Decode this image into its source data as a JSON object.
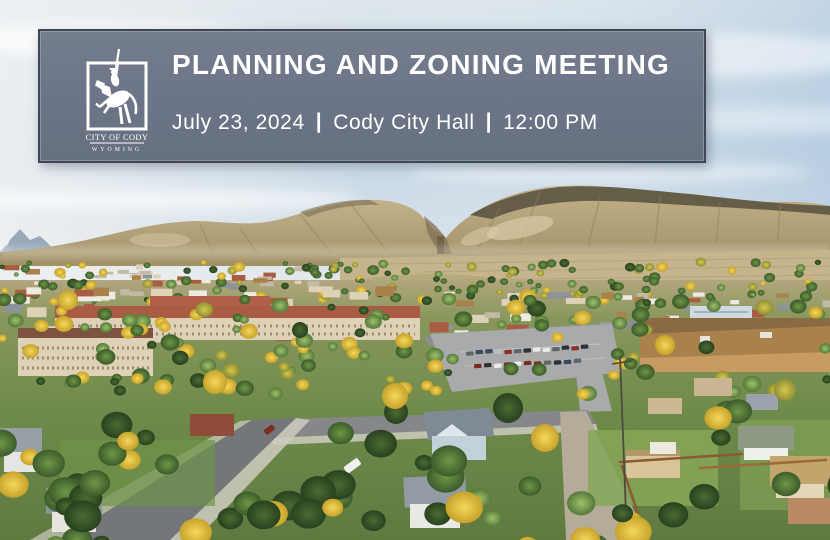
{
  "banner": {
    "title": "PLANNING AND ZONING MEETING",
    "date": "July 23, 2024",
    "separator": "|",
    "location": "Cody City Hall",
    "time": "12:00 PM",
    "colors": {
      "background": "#6c7587",
      "border": "#3f4754",
      "text": "#ffffff"
    }
  },
  "logo": {
    "name": "CITY OF CODY",
    "state": "WYOMING",
    "color": "#ffffff"
  },
  "photo": {
    "palette": {
      "sky_top": "#e7ecef",
      "sky_blue": "#c2d5e6",
      "sky_horizon": "#e6eaec",
      "cloud": "#ffffff",
      "distant_peak": "#90a0b4",
      "mountain": "#b5a37d",
      "mountain_shadow": "#8f7f5e",
      "mountain_dark_top": "#5d5742",
      "scree": "#d8caa6",
      "canyon_shadow": "#806f51",
      "plain": "#c6b58c",
      "plain_line": "#ae9c72",
      "ground_top": "#b2a67e",
      "ground_green": "#6f8b4a",
      "lawn": "#86a758",
      "road": "#74777a",
      "road_light": "#8d8f92",
      "sidewalk": "#cfccbf",
      "gravel": "#b4ab99",
      "parking": "#a8aaab",
      "roof_red": "#a95c43",
      "roof_brown": "#a9814c",
      "roof_gray": "#8b939b",
      "roof_dark_red": "#8f4c38",
      "wall_beige": "#ddd2b8",
      "wall_white": "#eceae2",
      "wall_tan": "#c79b62",
      "gym_roof": "#cfd9df",
      "house_blue": "#c3d2da",
      "fence": "#8a5a30",
      "fence_light": "#9c6a38",
      "pole": "#4d4b40",
      "truck_white": "#f0f1ee",
      "car_colors": [
        "#2e3133",
        "#8e2f28",
        "#ececea",
        "#b9bcbf",
        "#3a4a5e",
        "#60656a",
        "#7a2c22"
      ]
    }
  }
}
